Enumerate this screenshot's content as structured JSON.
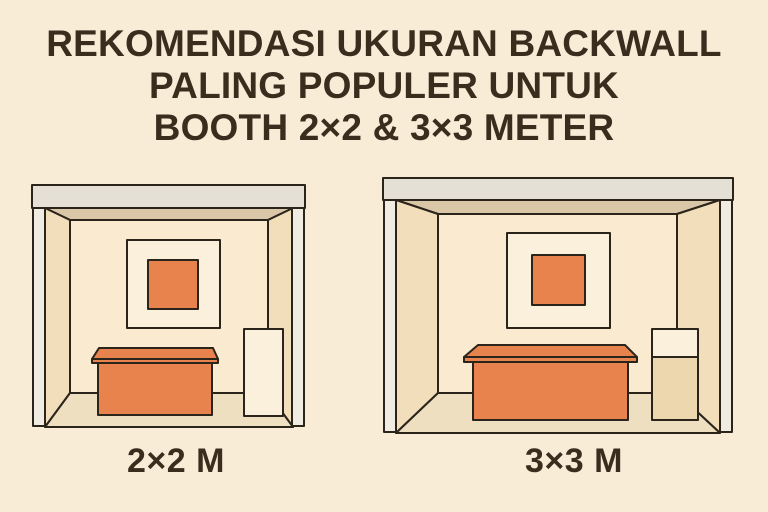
{
  "title": {
    "line1": "REKOMENDASI UKURAN BACKWALL",
    "line2": "PALING POPULER UNTUK",
    "line3": "BOOTH 2×2 & 3×3 METER"
  },
  "booths": [
    {
      "label": "2×2 M"
    },
    {
      "label": "3×3 M"
    }
  ],
  "colors": {
    "background": "#f8ecd7",
    "fascia": "#e5e0d6",
    "pillar": "#f1ece2",
    "ceiling": "#d9c7a7",
    "side_wall": "#f2deba",
    "back_wall": "#f9ead0",
    "floor": "#efdfc1",
    "frame": "#faf0dc",
    "accent_orange": "#e8834e",
    "cabinet_top": "#faf0dc",
    "cabinet_bottom": "#ecd7af",
    "outline": "#2b241b",
    "text": "#3a2d1e"
  }
}
